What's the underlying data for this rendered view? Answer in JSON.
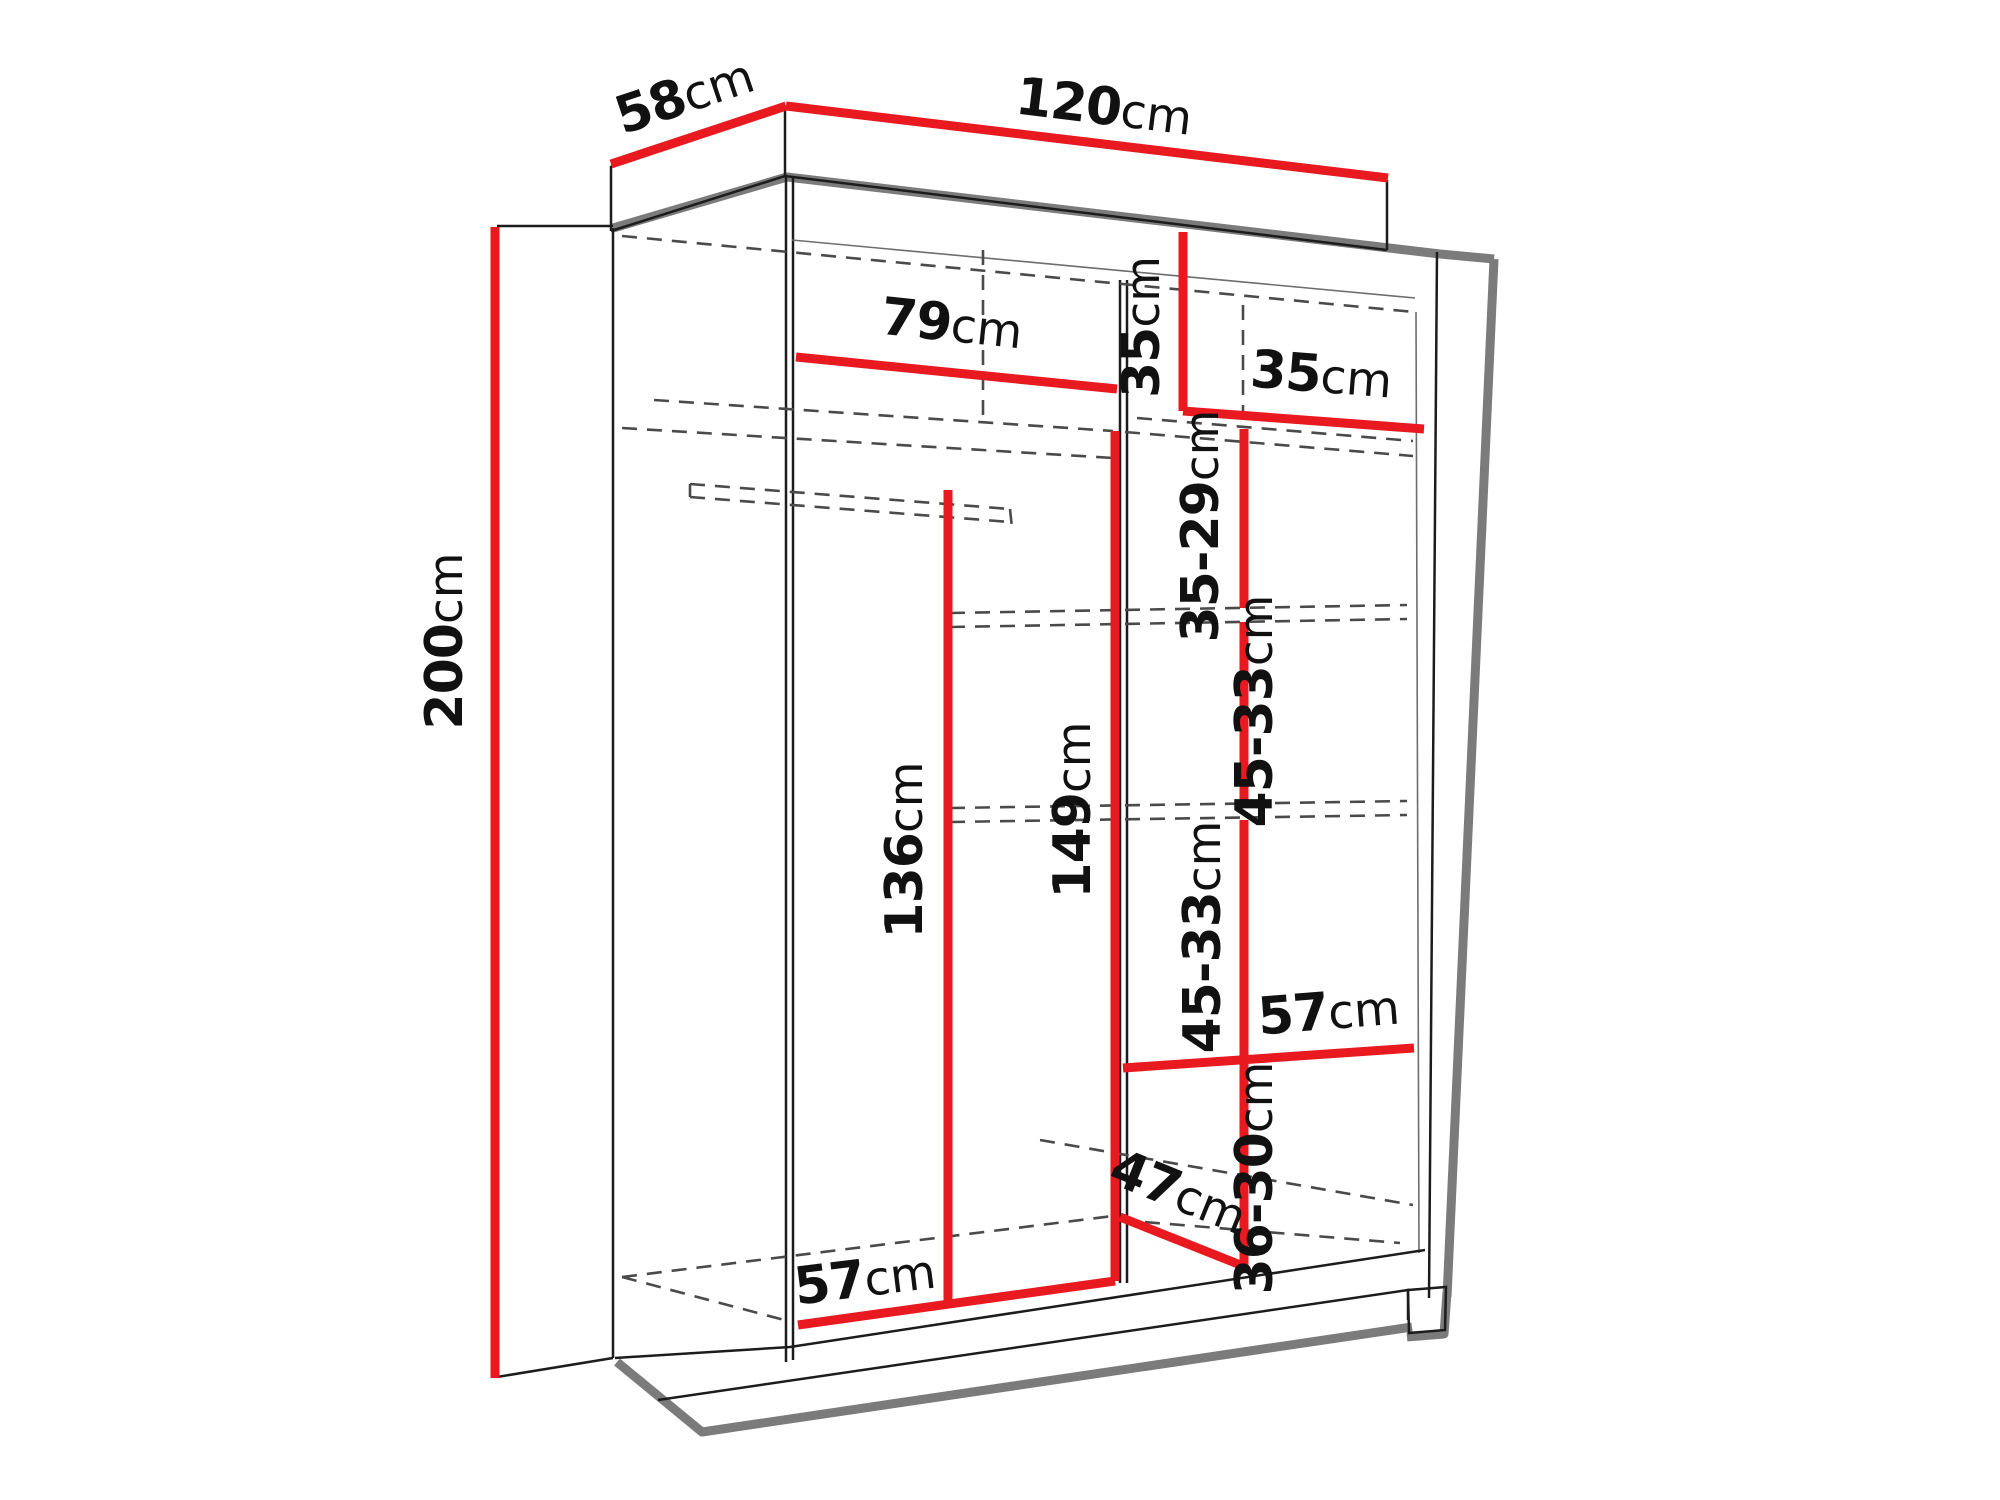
{
  "diagram": {
    "subject": "wardrobe-interior-dimensions",
    "unit": "cm",
    "colors": {
      "dimension_line": "#e8191f",
      "outline": "#1c1c1c",
      "structure_gray": "#7b7b7b",
      "hidden_edge_dash": "#4a4a4a",
      "label_text": "#111111",
      "background": "#ffffff"
    },
    "overall": {
      "width": "120",
      "depth": "58",
      "height": "200"
    },
    "dimensions": [
      {
        "id": "depth-top",
        "value": "58",
        "unit": "cm",
        "x": 690,
        "y": 112,
        "rot": -18.5
      },
      {
        "id": "width-top",
        "value": "120",
        "unit": "cm",
        "x": 1102,
        "y": 124,
        "rot": 7
      },
      {
        "id": "height-left",
        "value": "200",
        "unit": "cm",
        "x": 462,
        "y": 641,
        "rot": -90
      },
      {
        "id": "left-section-width",
        "value": "79",
        "unit": "cm",
        "x": 950,
        "y": 341,
        "rot": 6
      },
      {
        "id": "top-compartment-height",
        "value": "35",
        "unit": "cm",
        "x": 1159,
        "y": 327,
        "rot": -90
      },
      {
        "id": "right-column-width",
        "value": "35",
        "unit": "cm",
        "x": 1320,
        "y": 392,
        "rot": 4.5
      },
      {
        "id": "shelf-gap-1",
        "value": "35-29",
        "unit": "cm",
        "x": 1218,
        "y": 526,
        "rot": -90
      },
      {
        "id": "shelf-gap-2",
        "value": "45-33",
        "unit": "cm",
        "x": 1272,
        "y": 711,
        "rot": -90
      },
      {
        "id": "left-clear-height",
        "value": "136",
        "unit": "cm",
        "x": 922,
        "y": 850,
        "rot": -90
      },
      {
        "id": "partition-height",
        "value": "149",
        "unit": "cm",
        "x": 1090,
        "y": 810,
        "rot": -90
      },
      {
        "id": "shelf-gap-3",
        "value": "45-33",
        "unit": "cm",
        "x": 1220,
        "y": 937,
        "rot": -90
      },
      {
        "id": "shelf-depth-mid",
        "value": "57",
        "unit": "cm",
        "x": 1330,
        "y": 1029,
        "rot": -4.5
      },
      {
        "id": "shelf-gap-4",
        "value": "36-30",
        "unit": "cm",
        "x": 1272,
        "y": 1178,
        "rot": -90
      },
      {
        "id": "bottom-diagonal",
        "value": "47",
        "unit": "cm",
        "x": 1172,
        "y": 1208,
        "rot": 22
      },
      {
        "id": "floor-depth",
        "value": "57",
        "unit": "cm",
        "x": 867,
        "y": 1296,
        "rot": -7
      }
    ]
  }
}
